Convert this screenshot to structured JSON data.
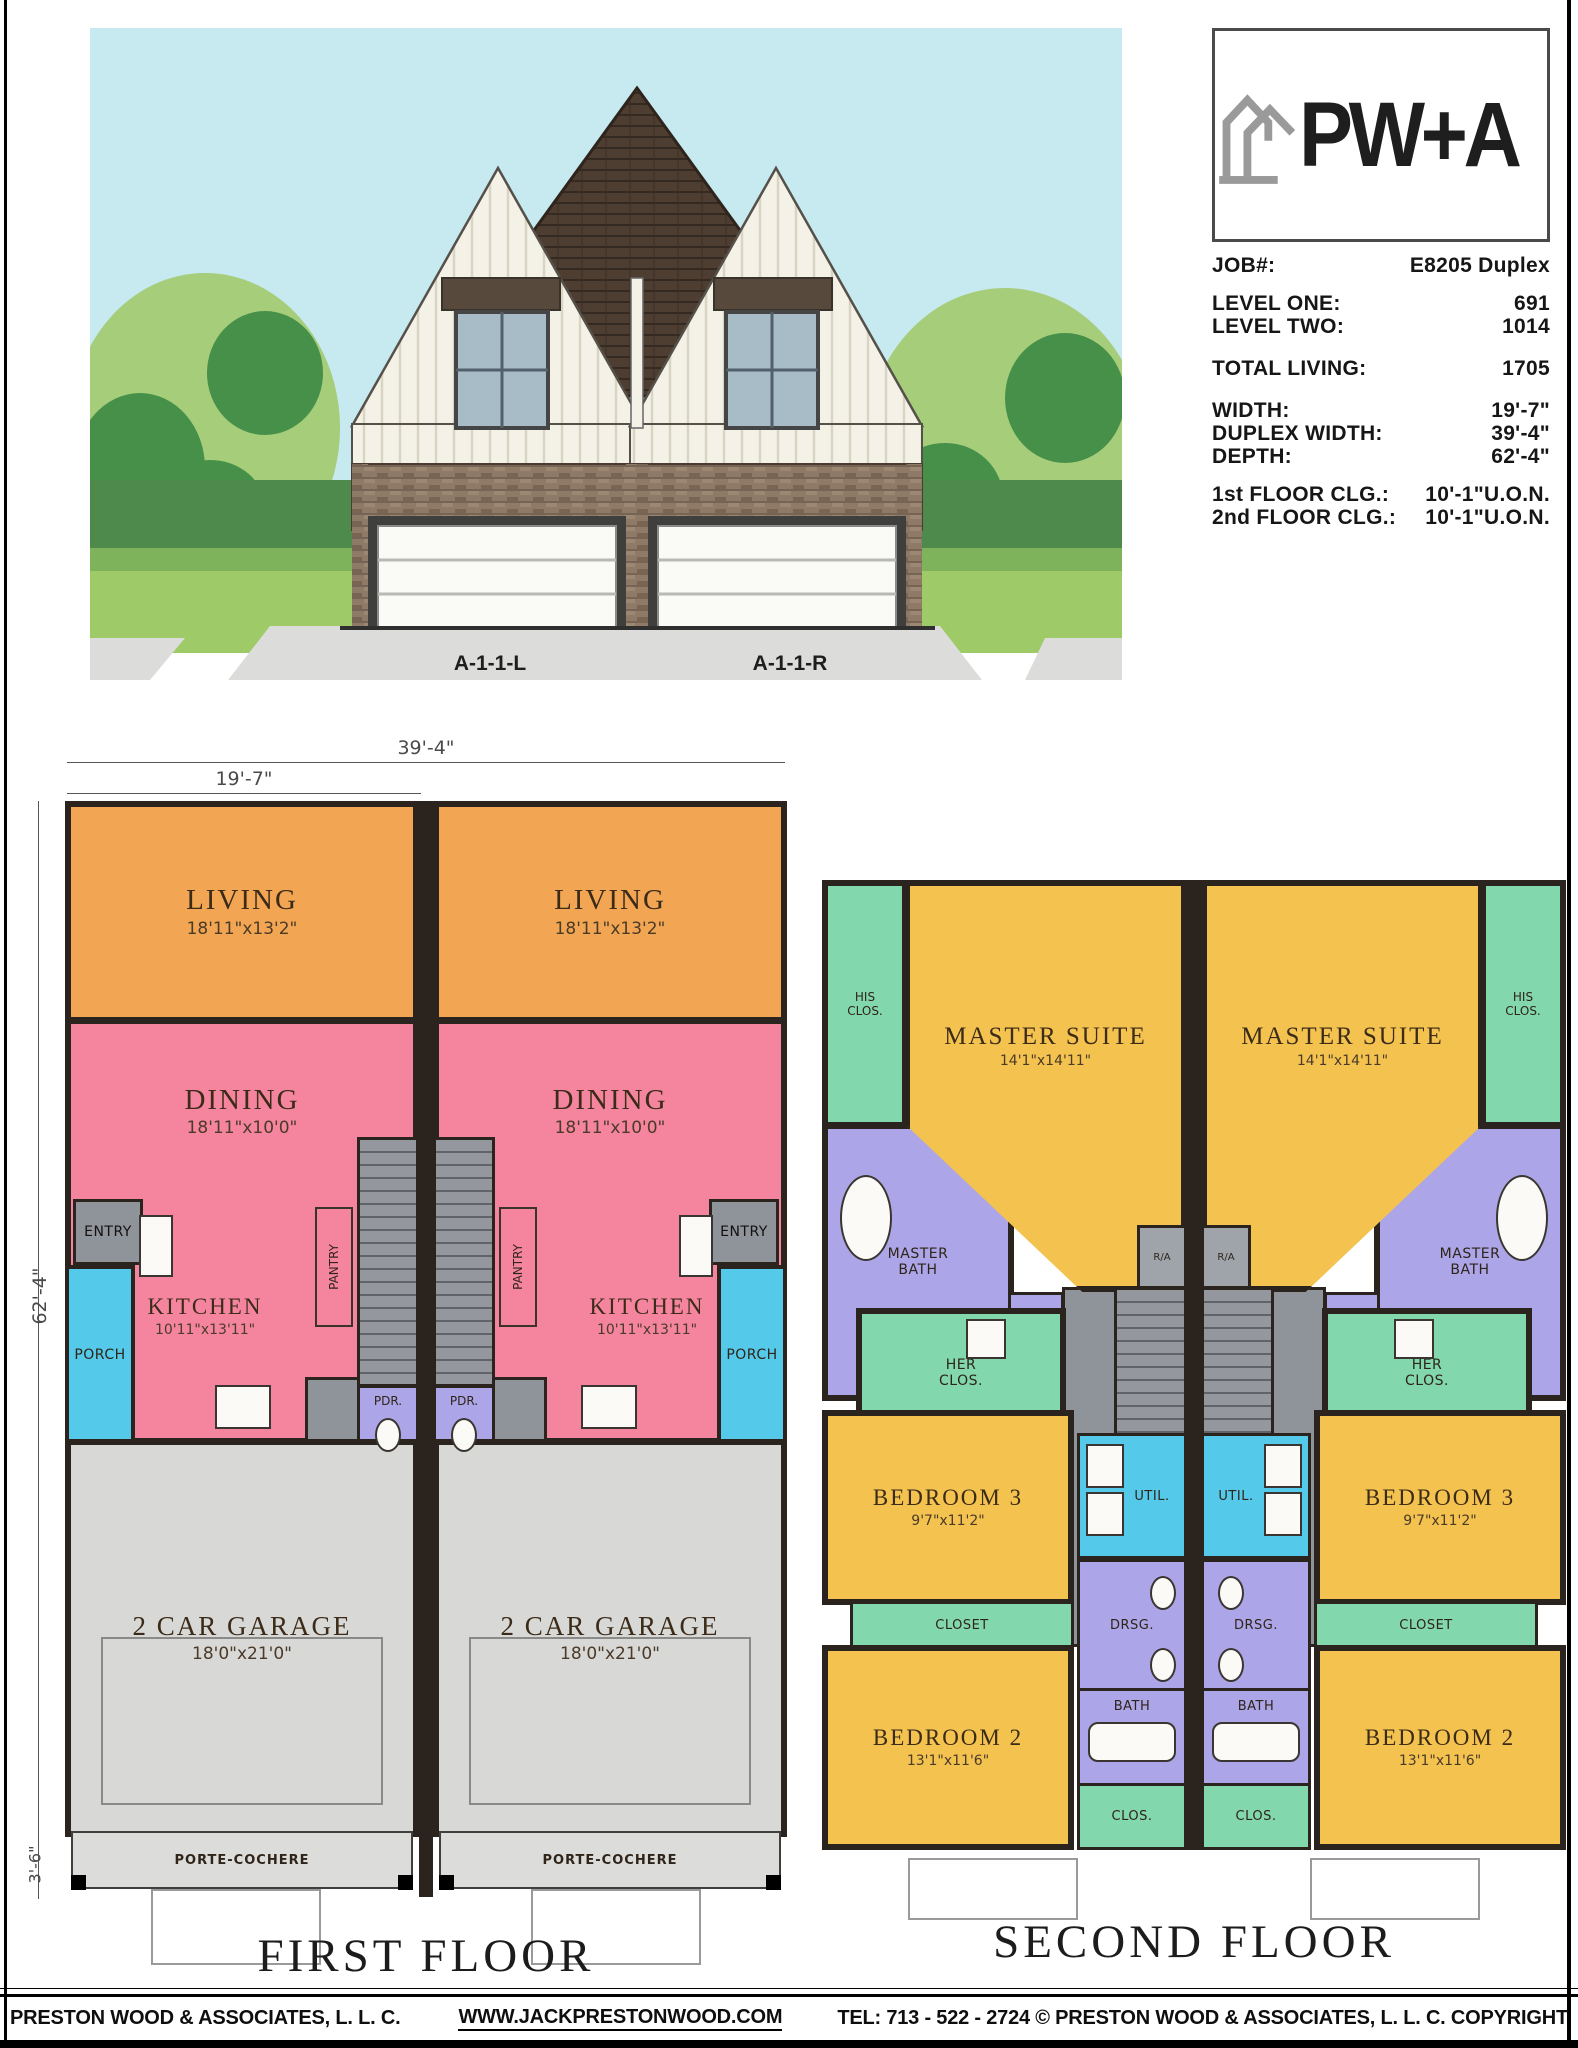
{
  "logo": {
    "wordmark": "PW+A"
  },
  "specs": {
    "rows": [
      {
        "label": "JOB#:",
        "value": "E8205 Duplex"
      },
      {
        "label": "LEVEL ONE:",
        "value": "691"
      },
      {
        "label": "LEVEL TWO:",
        "value": "1014"
      },
      {
        "label": "TOTAL LIVING:",
        "value": "1705"
      },
      {
        "label": "WIDTH:",
        "value": "19'-7\""
      },
      {
        "label": "DUPLEX WIDTH:",
        "value": "39'-4\""
      },
      {
        "label": "DEPTH:",
        "value": "62'-4\""
      },
      {
        "label": "1st FLOOR CLG.:",
        "value": "10'-1\"U.O.N."
      },
      {
        "label": "2nd FLOOR CLG.:",
        "value": "10'-1\"U.O.N."
      }
    ]
  },
  "elevation": {
    "label_left": "A-1-1-L",
    "label_right": "A-1-1-R"
  },
  "first_floor": {
    "title": "FIRST FLOOR",
    "dims": {
      "total_width": "39'-4\"",
      "unit_width": "19'-7\"",
      "depth": "62'-4\"",
      "porte": "3'-6\""
    },
    "rooms": {
      "living": {
        "name": "LIVING",
        "dim": "18'11\"x13'2\""
      },
      "dining": {
        "name": "DINING",
        "dim": "18'11\"x10'0\""
      },
      "kitchen": {
        "name": "KITCHEN",
        "dim": "10'11\"x13'11\""
      },
      "entry": {
        "name": "ENTRY"
      },
      "porch": {
        "name": "PORCH"
      },
      "pantry": {
        "name": "PANTRY"
      },
      "pdr": {
        "name": "PDR."
      },
      "garage": {
        "name": "2 CAR GARAGE",
        "dim": "18'0\"x21'0\""
      },
      "porte": {
        "name": "PORTE-COCHERE"
      }
    }
  },
  "second_floor": {
    "title": "SECOND FLOOR",
    "rooms": {
      "master_suite": {
        "name": "MASTER SUITE",
        "dim": "14'1\"x14'11\""
      },
      "his_clos": {
        "name": "HIS CLOS."
      },
      "master_bath": {
        "name": "MASTER BATH"
      },
      "her_clos": {
        "name": "HER CLOS."
      },
      "linen": {
        "name": "LINEN"
      },
      "bedroom3": {
        "name": "BEDROOM 3",
        "dim": "9'7\"x11'2\""
      },
      "util": {
        "name": "UTIL."
      },
      "drsg": {
        "name": "DRSG."
      },
      "closet": {
        "name": "CLOSET"
      },
      "bath": {
        "name": "BATH"
      },
      "bedroom2": {
        "name": "BEDROOM 2",
        "dim": "13'1\"x11'6\""
      },
      "clos": {
        "name": "CLOS."
      },
      "ra": {
        "name": "R/A"
      }
    }
  },
  "footer": {
    "company": "PRESTON WOOD & ASSOCIATES, L. L. C.",
    "website": "WWW.JACKPRESTONWOOD.COM",
    "tel": "TEL:  713 - 522 - 2724",
    "copyright": "© PRESTON WOOD & ASSOCIATES, L. L. C.  COPYRIGHT"
  },
  "palette": {
    "living": "#F2A653",
    "dining_kitchen": "#F5859E",
    "porch_util": "#55C9E9",
    "entry_stairs": "#8F939A",
    "powder_bath": "#ACA5E7",
    "garage": "#D8D8D6",
    "suite_bedroom": "#F3C24F",
    "closet": "#82D7AD",
    "walls": "#2B241E",
    "sky": "#C7E9F0"
  }
}
